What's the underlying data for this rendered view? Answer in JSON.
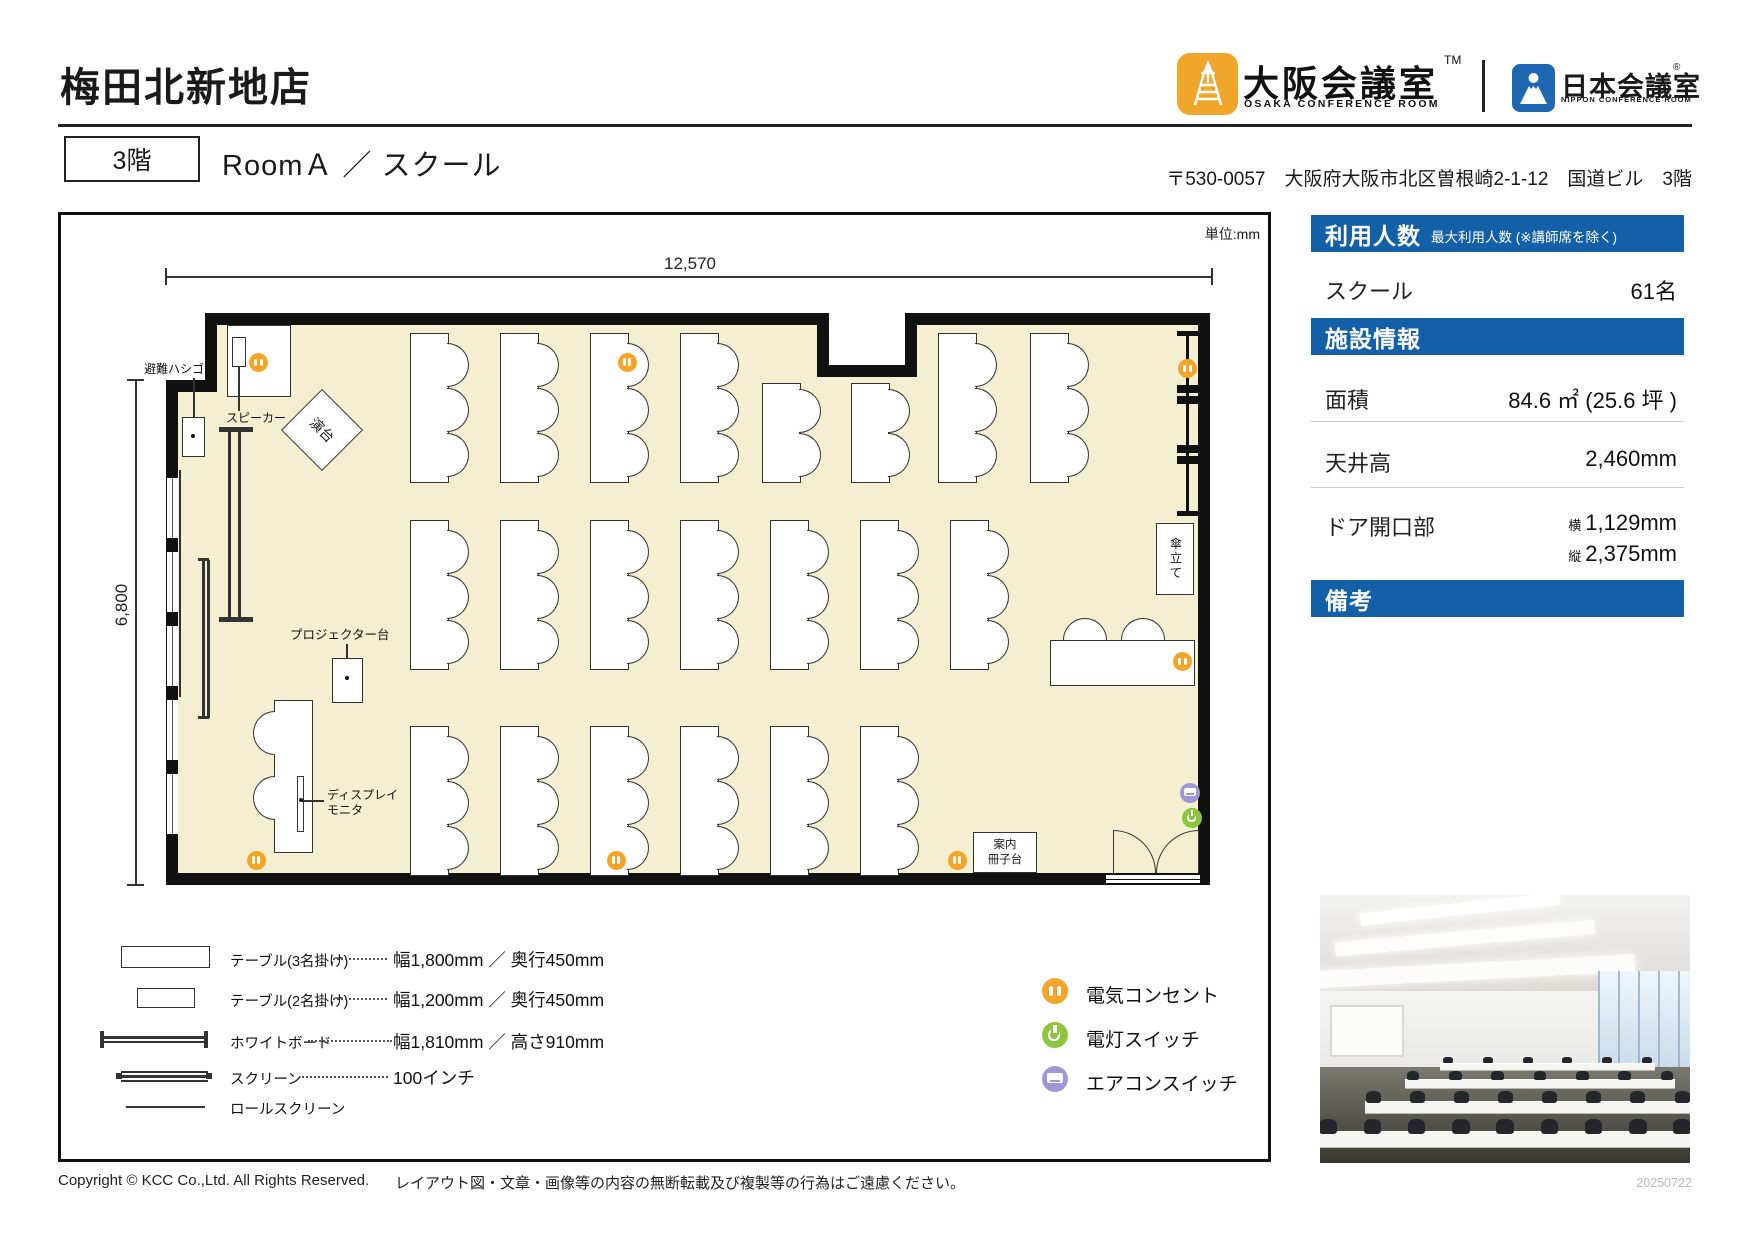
{
  "header": {
    "store_title": "梅田北新地店",
    "floor_badge": "3階",
    "room_title": "RoomＡ ／ スクール",
    "address": "〒530-0057　大阪府大阪市北区曽根崎2-1-12　国道ビル　3階",
    "osaka_logo": {
      "jp": "大阪会議室",
      "tm": "TM",
      "en": "OSAKA CONFERENCE ROOM"
    },
    "nippon_logo": {
      "jp": "日本会議室",
      "reg": "®",
      "en": "NIPPON CONFERENCE ROOM"
    }
  },
  "plan": {
    "unit_note": "単位:mm",
    "dim_width": "12,570",
    "dim_height": "6,800",
    "labels": {
      "escape_ladder": "避難ハシゴ",
      "speaker": "スピーカー",
      "lectern": "演台",
      "projector_stand": "プロジェクター台",
      "display_monitor_1": "ディスプレイ",
      "display_monitor_2": "モニタ",
      "umbrella_stand": "傘立て",
      "booklet_stand_1": "案内",
      "booklet_stand_2": "冊子台"
    }
  },
  "legend": {
    "items": [
      {
        "label": "テーブル(3名掛け)",
        "value": "幅1,800mm ／ 奥行450mm"
      },
      {
        "label": "テーブル(2名掛け)",
        "value": "幅1,200mm ／ 奥行450mm"
      },
      {
        "label": "ホワイトボード",
        "value": "幅1,810mm ／ 高さ910mm"
      },
      {
        "label": "スクリーン",
        "value": "100インチ"
      },
      {
        "label": "ロールスクリーン",
        "value": ""
      }
    ],
    "icons": [
      {
        "label": "電気コンセント"
      },
      {
        "label": "電灯スイッチ"
      },
      {
        "label": "エアコンスイッチ"
      }
    ]
  },
  "info_panel": {
    "capacity_header": "利用人数",
    "capacity_note": "最大利用人数 (※講師席を除く)",
    "capacity_row": {
      "label": "スクール",
      "value": "61名"
    },
    "facility_header": "施設情報",
    "area": {
      "label": "面積",
      "value": "84.6 ㎡ (25.6 坪 )"
    },
    "ceiling": {
      "label": "天井高",
      "value": "2,460mm"
    },
    "door": {
      "label": "ドア開口部",
      "w_prefix": "横",
      "w_value": "1,129mm",
      "h_prefix": "縦",
      "h_value": "2,375mm"
    },
    "notes_header": "備考"
  },
  "footer": {
    "copyright": "Copyright © KCC Co.,Ltd. All Rights Reserved.",
    "notice": "レイアウト図・文章・画像等の内容の無断転載及び複製等の行為はご遠慮ください。",
    "date": "20250722"
  },
  "colors": {
    "accent_blue": "#1460A8",
    "room_cream": "#F3EFD0",
    "outlet_orange": "#F4A427",
    "light_green": "#8CC63F",
    "aircon_purple": "#9E97D6"
  }
}
